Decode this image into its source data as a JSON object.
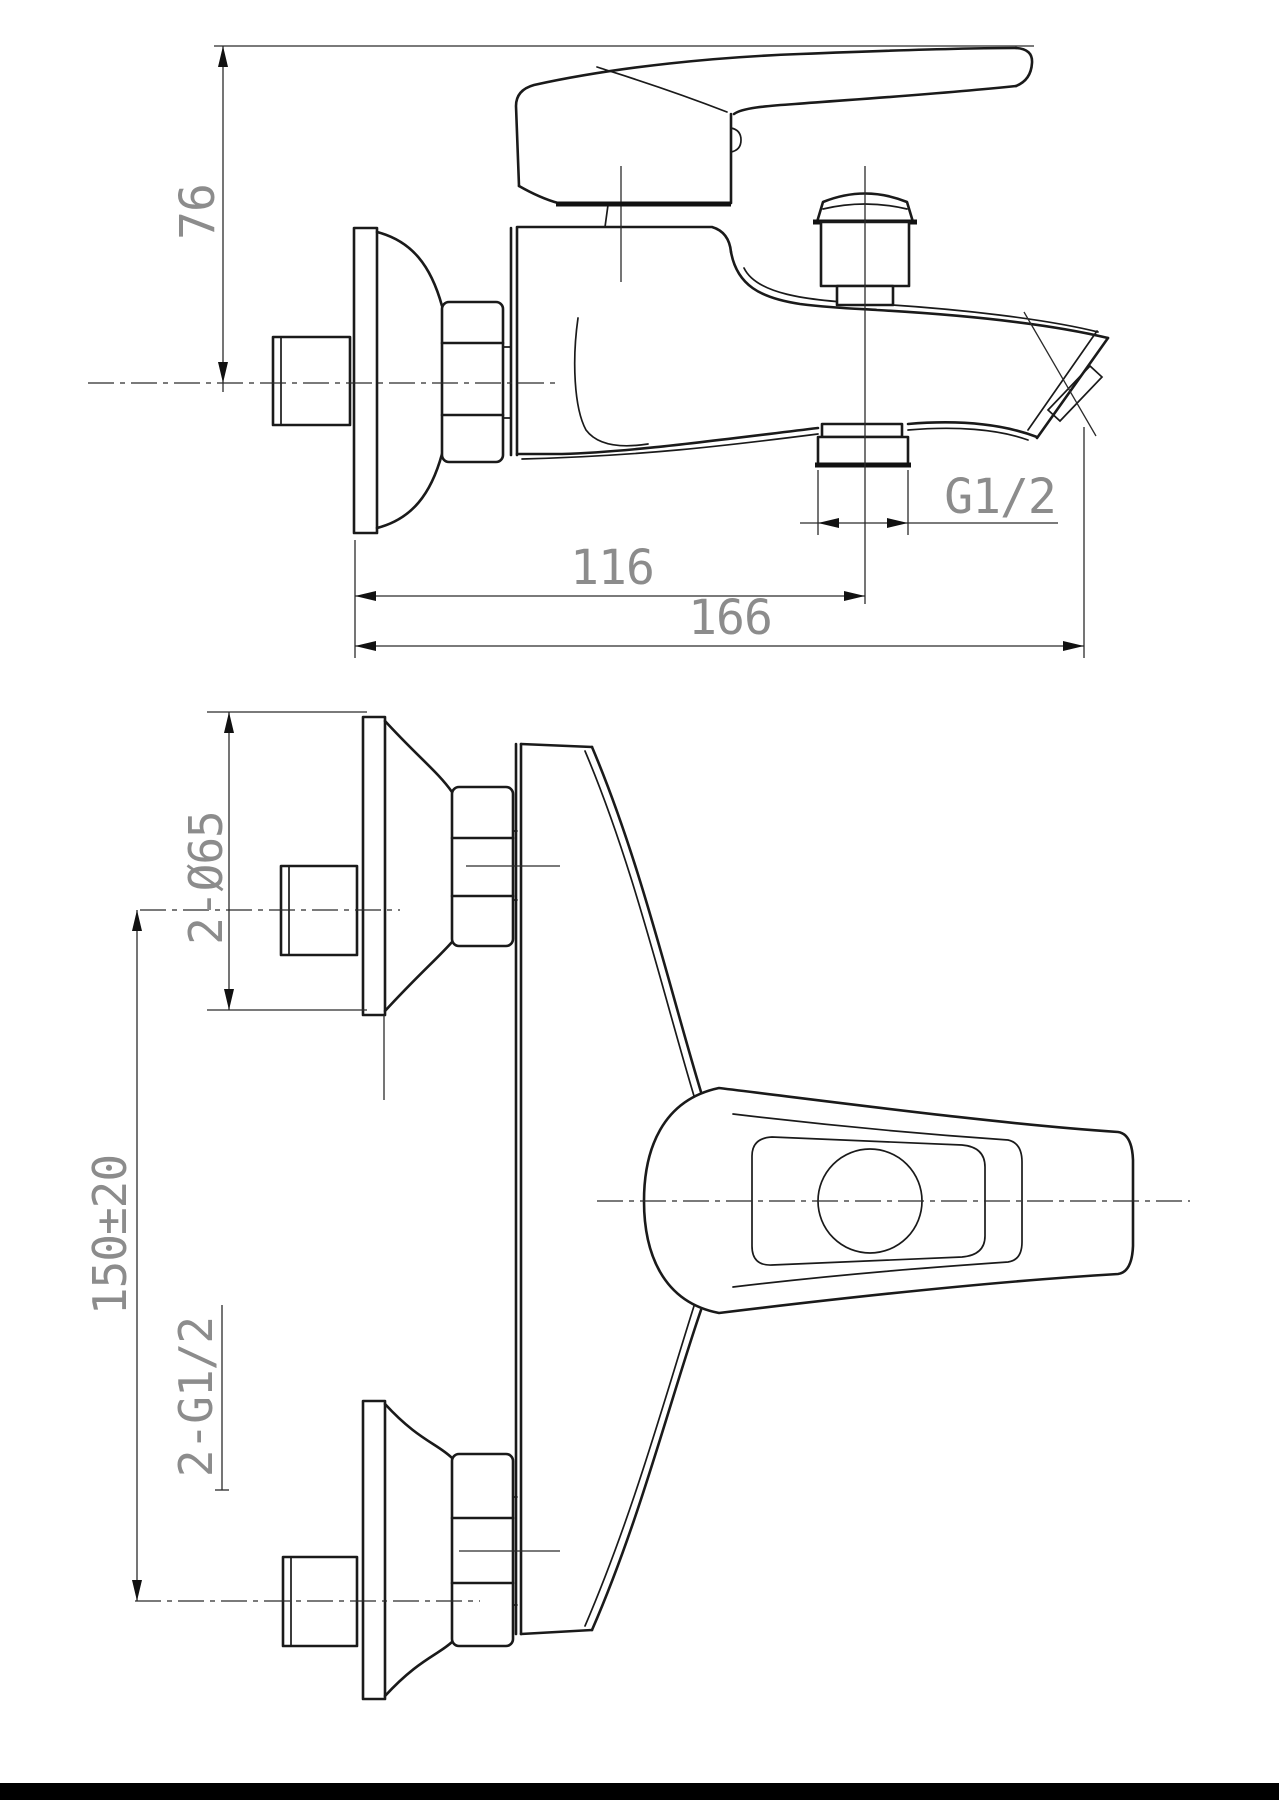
{
  "page": {
    "background": "#ffffff",
    "line_color": "#1a1a1a",
    "dimension_text_color": "#8c8c8c",
    "footer_bar_color": "#000000",
    "description": "Technical dimensional drawing of a wall-mounted single-lever bath mixer faucet, side elevation view (top) and plan view (bottom)"
  },
  "side_view": {
    "dim_height": "76",
    "dim_spout_center": "116",
    "dim_total_length": "166",
    "thread_label": "G1/2"
  },
  "plan_view": {
    "dim_flange": "2-Ø65",
    "dim_centers": "150±20",
    "thread_label": "2-G1/2"
  }
}
